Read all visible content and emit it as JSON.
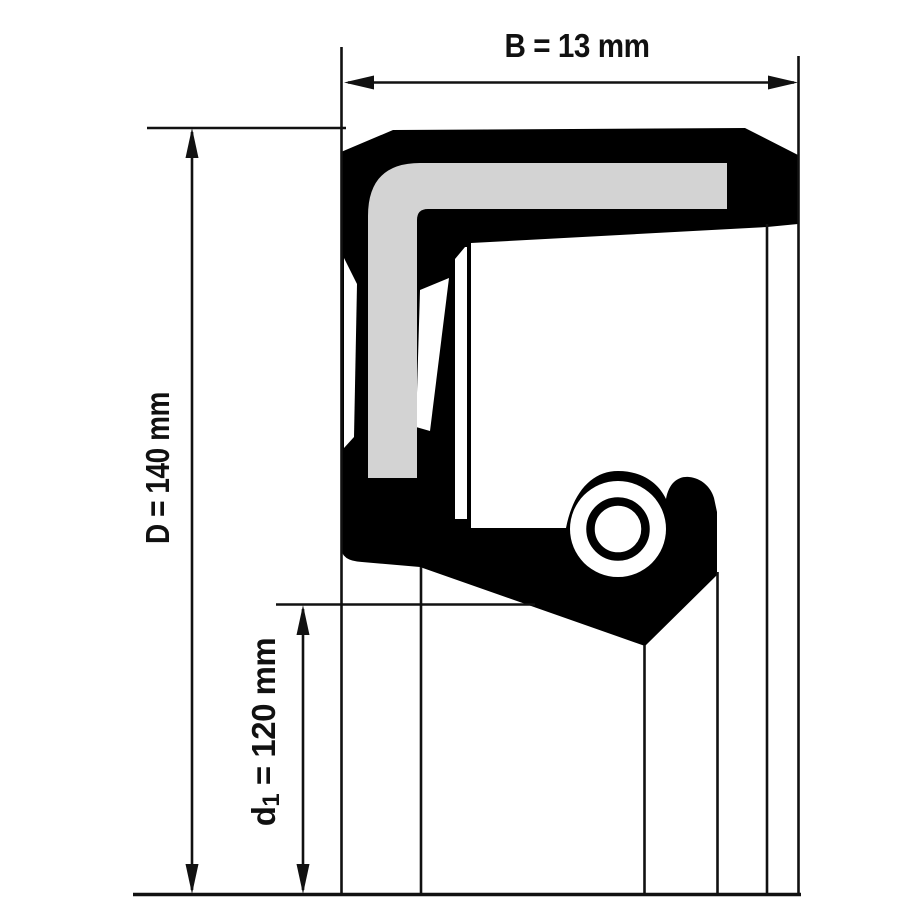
{
  "figure": {
    "type": "technical-drawing",
    "subject": "radial-shaft-seal-cross-section",
    "background": "#ffffff",
    "colors": {
      "seal_body": "#000000",
      "metal_insert": "#d3d3d3",
      "construction_lines": "#111111",
      "text": "#111111"
    },
    "dimensions": [
      {
        "id": "B",
        "label": "B = 13 mm",
        "value_mm": 13,
        "meaning": "seal width",
        "orientation": "horizontal"
      },
      {
        "id": "D",
        "label": "D = 140 mm",
        "value_mm": 140,
        "meaning": "outer diameter",
        "orientation": "vertical"
      },
      {
        "id": "d1",
        "label": "d1 = 120 mm",
        "value_mm": 120,
        "meaning": "inner/shaft diameter",
        "orientation": "vertical"
      }
    ],
    "labels": {
      "b": "B = 13 mm",
      "d_cap": "D = 140 mm",
      "d1_prefix": "d",
      "d1_sub": "1",
      "d1_rest": " = 120 mm"
    }
  }
}
